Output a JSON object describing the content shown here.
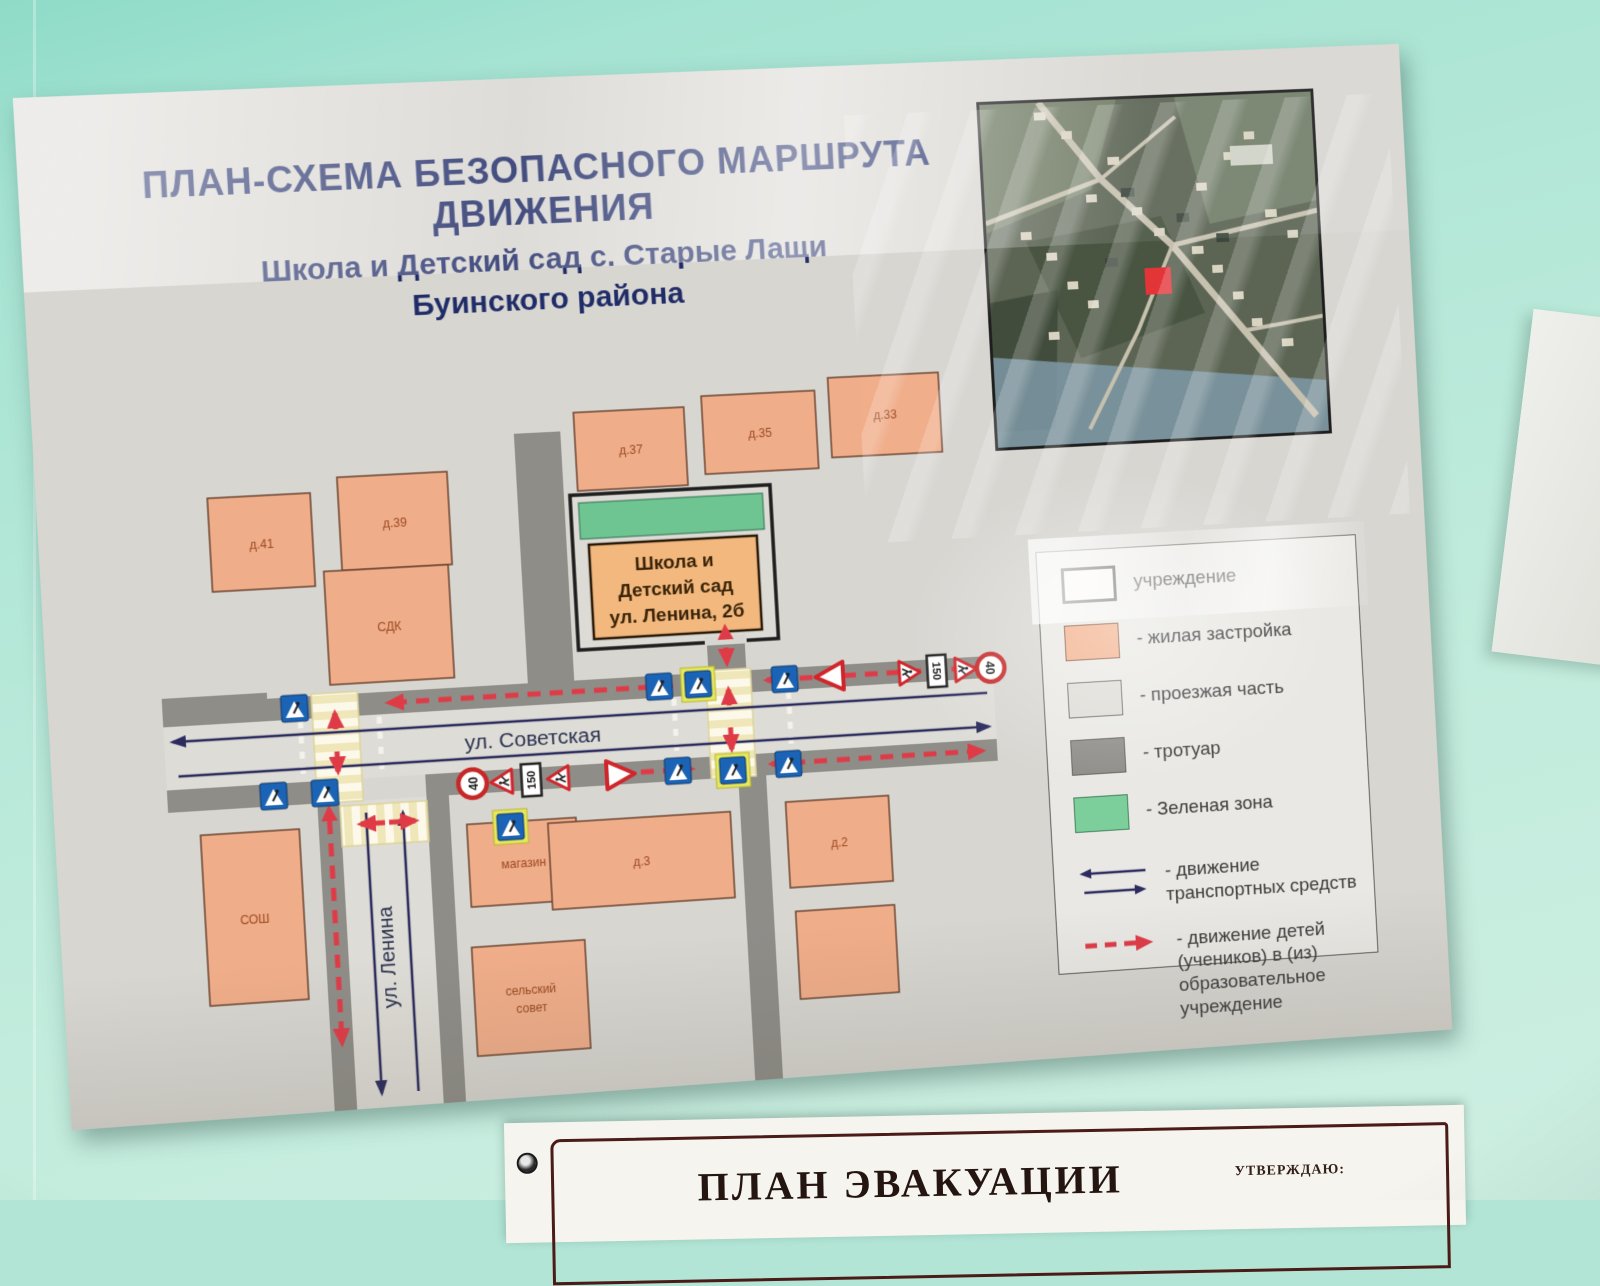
{
  "title": {
    "line1": "ПЛАН-СХЕМА БЕЗОПАСНОГО МАРШРУТА ДВИЖЕНИЯ",
    "line2": "Школа и Детский сад с. Старые Лащи",
    "line3": "Буинского района"
  },
  "map": {
    "streets": {
      "horizontal": "ул. Советская",
      "vertical": "ул. Ленина"
    },
    "school": {
      "line1": "Школа и",
      "line2": "Детский сад",
      "line3": "ул. Ленина, 2б"
    },
    "buildings": [
      {
        "label": "д.41"
      },
      {
        "label": "д.39"
      },
      {
        "label": "СДК"
      },
      {
        "label": "д.37"
      },
      {
        "label": "д.35"
      },
      {
        "label": "д.33"
      },
      {
        "label": "СОШ"
      },
      {
        "label": "магазин"
      },
      {
        "label": "сельский",
        "label2": "совет"
      },
      {
        "label": "д.3"
      },
      {
        "label": "д.2"
      },
      {
        "label": ""
      }
    ],
    "signs": {
      "speed_limit": "40",
      "distance_plate": "150"
    }
  },
  "legend": {
    "items": [
      {
        "label": "учреждение",
        "color": "#f7f5f0"
      },
      {
        "label": "- жилая застройка",
        "color": "#f2ae88"
      },
      {
        "label": "- проезжая часть",
        "color": "#dedcd6"
      },
      {
        "label": "- тротуар",
        "color": "#8f8d88"
      },
      {
        "label": "- Зеленая зона",
        "color": "#7ccf9b"
      },
      {
        "label": "- движение транспортных средств",
        "color": "#2b2b5e"
      },
      {
        "label": "- движение детей (учеников) в (из) образовательное учреждение",
        "color": "#df3b47"
      }
    ]
  },
  "evacuation_sign": {
    "title": "ПЛАН ЭВАКУАЦИИ",
    "approval": "УТВЕРЖДАЮ:"
  },
  "colors": {
    "wall": "#b2e5d6",
    "poster": "#d8d6d1",
    "residential": "#f2ae88",
    "roadway": "#dedcd6",
    "sidewalk": "#8f8d88",
    "green_zone": "#7ccf9b",
    "children_route": "#df3b47",
    "traffic_arrows": "#2b2b5e",
    "title_text": "#202c68",
    "location_marker": "#e33236"
  }
}
